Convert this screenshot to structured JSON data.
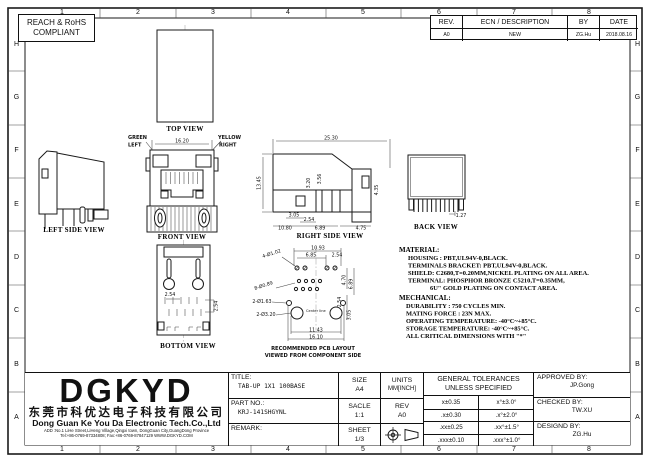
{
  "sheet": {
    "compliance": [
      "REACH & RoHS",
      "COMPLIANT"
    ],
    "zones_cols": [
      "1",
      "2",
      "3",
      "4",
      "5",
      "6",
      "7",
      "8"
    ],
    "zones_rows": [
      "H",
      "G",
      "F",
      "E",
      "D",
      "C",
      "B",
      "A"
    ]
  },
  "revision": {
    "headers": {
      "rev": "REV.",
      "ecn": "ECN / DESCRIPTION",
      "by": "BY",
      "date": "DATE"
    },
    "row": {
      "rev": "A0",
      "ecn": "NEW",
      "by": "ZG.Hu",
      "date": "2018.08.16"
    }
  },
  "views": {
    "top": {
      "label": "TOP VIEW"
    },
    "left": {
      "label": "LEFT SIDE VIEW"
    },
    "front": {
      "label": "FRONT VIEW",
      "dim_width": "16.20",
      "led_left_line1": "GREEN",
      "led_left_line2": "LEFT",
      "led_right_line1": "YELLOW",
      "led_right_line2": "RIGHT",
      "led_left_color": "#0bd40b",
      "led_right_color": "#efe000"
    },
    "right": {
      "label": "RIGHT SIDE VIEW",
      "dims": {
        "w": "25.30",
        "h": "13.45",
        "a": "3.20",
        "b": "3.56",
        "c": "4.35",
        "d": "3.05",
        "e": "2.54",
        "f": "10.80",
        "g": "6.89",
        "h2": "4.75"
      }
    },
    "back": {
      "label": "BACK VIEW",
      "dim_pitch": "1.27"
    },
    "bottom": {
      "label": "BOTTOM VIEW",
      "dim1": "2.54",
      "dim2": "2.54"
    },
    "pcb": {
      "label1": "RECOMMENDED PCB LAYOUT",
      "label2": "VIEWED FROM COMPONENT SIDE",
      "center_note": "Center line",
      "callout_pads": "4-Ø1.02",
      "callout_holes": "8-Ø0.89",
      "callout_small": "2-Ø1.63",
      "callout_big": "2-Ø3.20",
      "dims": {
        "t1": "10.93",
        "t2": "6.85",
        "t3": "2.54",
        "r1": "4.70",
        "r2": "6.89",
        "r3": "2.54",
        "r4": "3.05",
        "b1": "11.43",
        "b2": "16.10"
      }
    }
  },
  "material": {
    "heading": "MATERIAL:",
    "lines": [
      "HOUSING : PBT,UL94V-0,BLACK.",
      "TERMINALS BRACKET: PBT,UL94V-0,BLACK.",
      "SHIELD: C2680,T=0.20MM,NICKEL PLATING ON ALL AREA.",
      "TERMINAL: PHOSPHOR BRONZE C5210,T=0.35MM,",
      "6U\" GOLD PLATING ON CONTACT AREA."
    ]
  },
  "mechanical": {
    "heading": "MECHANICAL:",
    "lines": [
      "DURABILITY : 750 CYCLES MIN.",
      "MATING FORCE : 23N MAX.",
      "OPERATING TEMPERATURE: -40°C~+85°C.",
      "STORAGE TEMPERATURE: -40°C~+85°C.",
      "ALL CRITICAL DIMENSIONS WITH \"*\""
    ]
  },
  "title_block": {
    "logo": "DGKYD",
    "company_cn": "东莞市科优达电子科技有限公司",
    "company_en": "Dong Guan Ke You Da Electronic Tech.Co.,Ltd",
    "address": "ADD :No.1 LiHe Street,LiHeng Village,Qingxi town, DongGuan City,GuangDong Province",
    "contact": "Tel:+86-0769-87334808; Fax:+86-0769-87847129  WWW.DGKYD.COM",
    "title_label": "TITLE:",
    "title_value": "TAB-UP 1X1 100BASE",
    "part_label": "PART NO.:",
    "part_value": "KRJ-141SHGYNL",
    "remark_label": "REMARK:",
    "size_label": "SIZE",
    "size_value": "A4",
    "units_label": "UNITS",
    "units_value": "MM[INCH]",
    "scale_label": "SACLE",
    "scale_value": "1:1",
    "rev_label": "REV",
    "rev_value": "A0",
    "sheet_label": "SHEET",
    "sheet_value": "1/3",
    "tol_header1": "GENERAL TOLERANCES",
    "tol_header2": "UNLESS SPECIFIED",
    "tolerances": [
      [
        "x±0.35",
        "x°±3.0°"
      ],
      [
        ".x±0.30",
        ".x°±2.0°"
      ],
      [
        ".xx±0.25",
        ".xx°±1.5°"
      ],
      [
        ".xxx±0.10",
        ".xxx°±1.0°"
      ]
    ],
    "approved_label": "APPROVED BY:",
    "approved_value": "JP.Gong",
    "checked_label": "CHECKED BY:",
    "checked_value": "TW.XU",
    "designed_label": "DESIGND BY:",
    "designed_value": "ZG.Hu"
  }
}
